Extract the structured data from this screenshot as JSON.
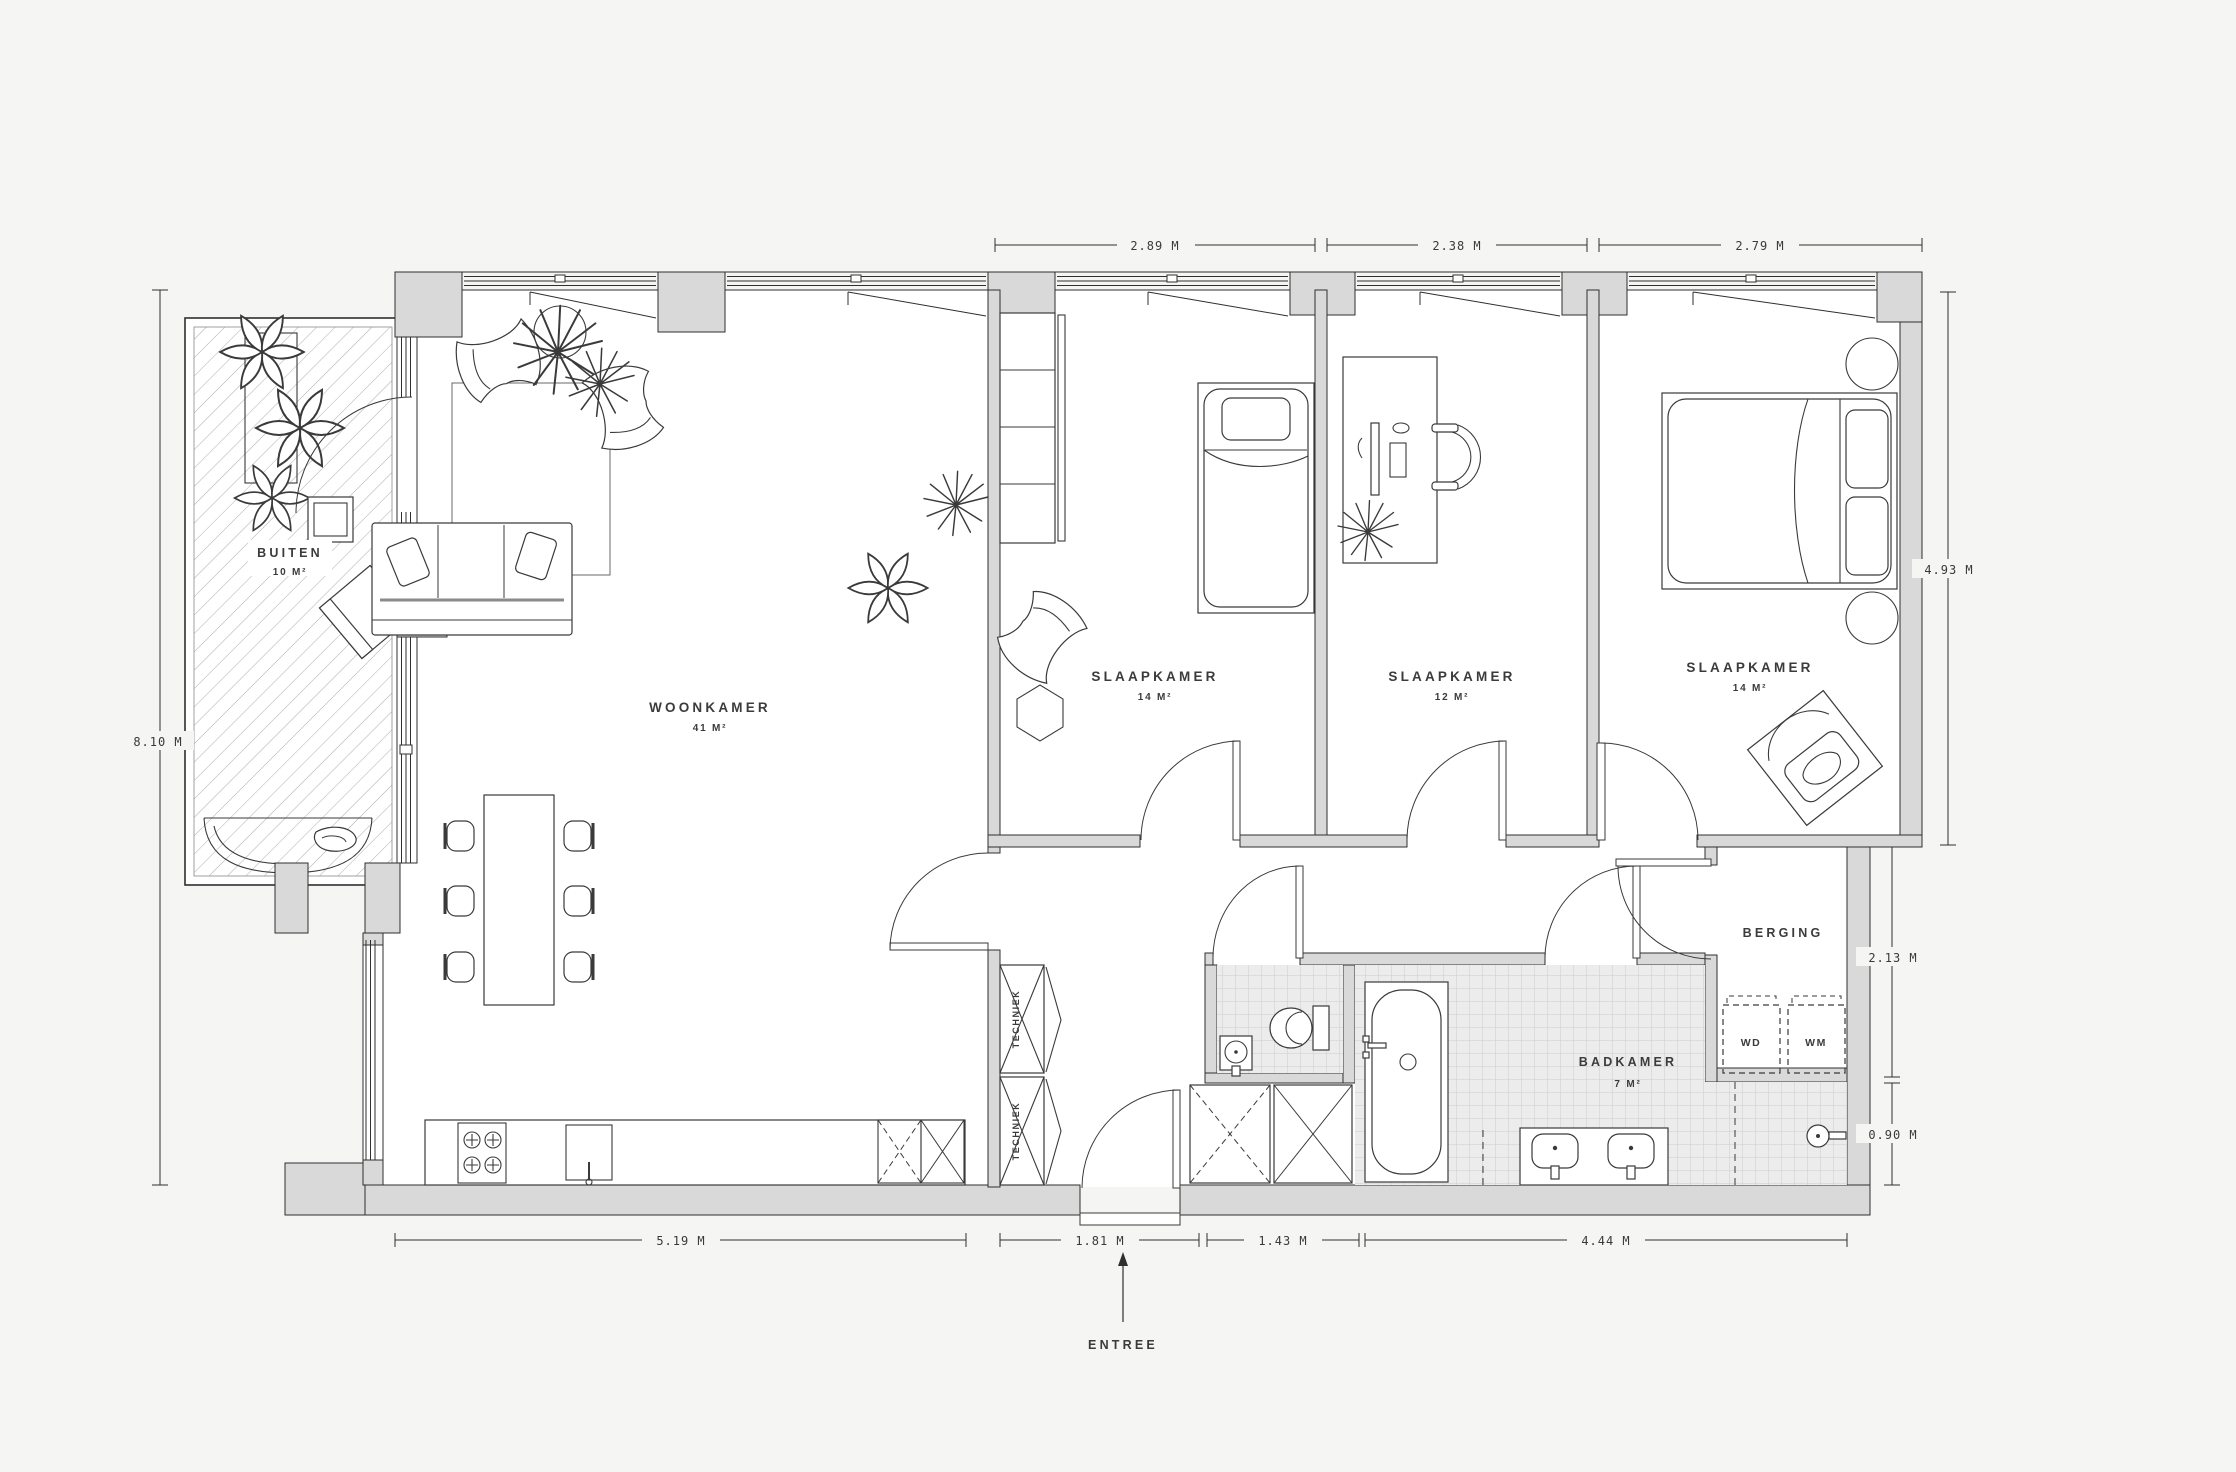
{
  "rooms": {
    "buiten": {
      "name": "BUITEN",
      "area": "10 M²"
    },
    "woonkamer": {
      "name": "WOONKAMER",
      "area": "41 M²"
    },
    "slaapkamer_1": {
      "name": "SLAAPKAMER",
      "area": "14 M²"
    },
    "slaapkamer_2": {
      "name": "SLAAPKAMER",
      "area": "12 M²"
    },
    "slaapkamer_3": {
      "name": "SLAAPKAMER",
      "area": "14 M²"
    },
    "badkamer": {
      "name": "BADKAMER",
      "area": "7 M²"
    },
    "berging": {
      "name": "BERGING"
    },
    "techniek_upper": {
      "name": "TECHNIEK"
    },
    "techniek_lower": {
      "name": "TECHNIEK"
    }
  },
  "appliances": {
    "dryer": "WD",
    "washer": "WM"
  },
  "entrance": {
    "label": "ENTREE"
  },
  "dimensions": {
    "top": [
      "2.89 M",
      "2.38 M",
      "2.79 M"
    ],
    "left": [
      "8.10 M"
    ],
    "right": [
      "4.93 M",
      "2.13 M",
      "0.90 M"
    ],
    "bottom": [
      "5.19 M",
      "1.81 M",
      "1.43 M",
      "4.44 M"
    ]
  },
  "colors": {
    "background": "#f5f5f3",
    "wall_fill": "#d9d9d9",
    "line": "#2f2f2f",
    "tile_line": "#cdcdcd",
    "text": "#3b3b3b"
  }
}
